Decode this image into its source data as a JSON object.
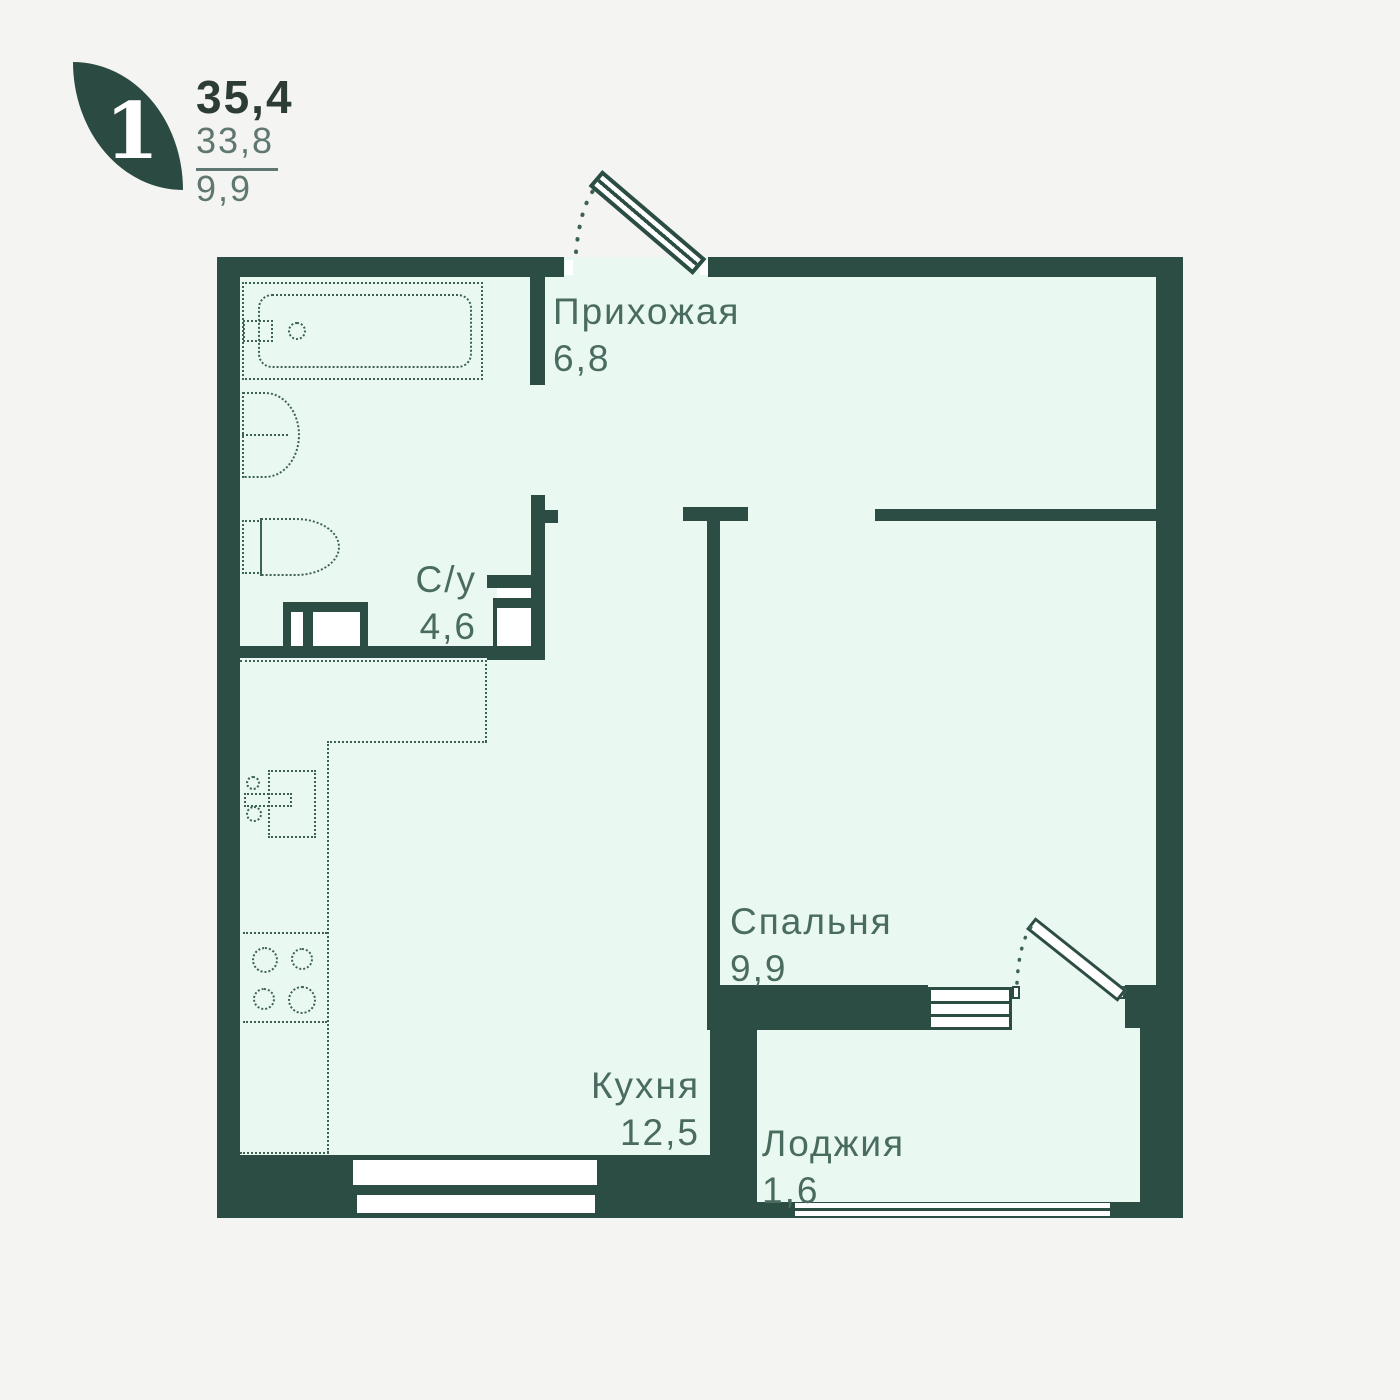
{
  "logo": {
    "rooms": "1",
    "area_total": "35,4",
    "area_living": "33,8",
    "area_kitchen": "9,9"
  },
  "rooms": [
    {
      "id": "hallway",
      "name": "Прихожая",
      "area": "6,8"
    },
    {
      "id": "bathroom",
      "name": "С/у",
      "area": "4,6"
    },
    {
      "id": "bedroom",
      "name": "Спальня",
      "area": "9,9"
    },
    {
      "id": "kitchen",
      "name": "Кухня",
      "area": "12,5"
    },
    {
      "id": "loggia",
      "name": "Лоджия",
      "area": "1,6"
    }
  ],
  "colors": {
    "wall": "#2b4d44",
    "room_fill": "#e9f9f1",
    "background": "#f4f4f2",
    "label": "#4a6b60",
    "fixture": "#3e6156",
    "logo_leaf": "#2a4a42",
    "accent_dark": "#2e3c36",
    "accent_muted": "#5f7770"
  }
}
